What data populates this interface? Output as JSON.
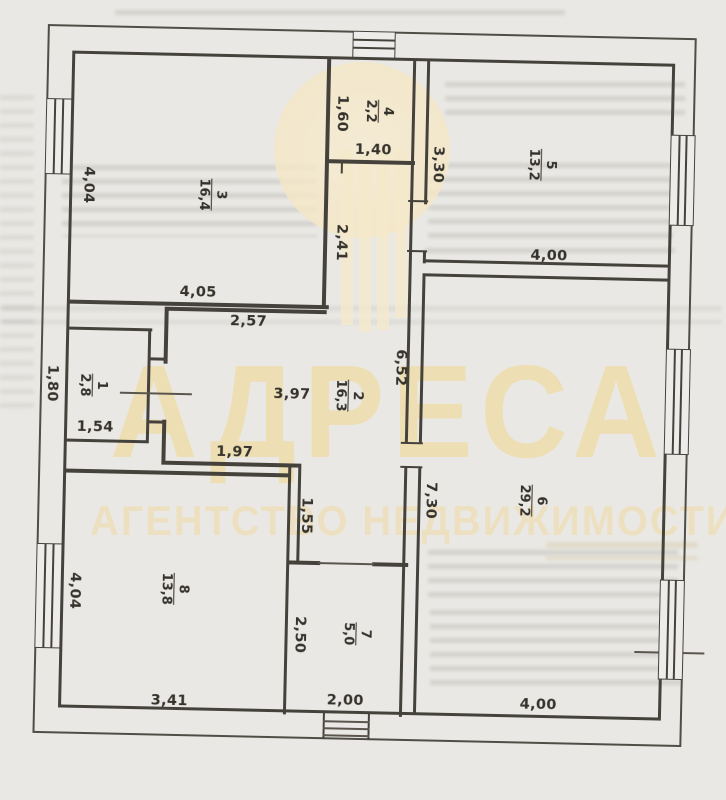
{
  "watermark": {
    "brand": "АДРЕСА",
    "tagline": "АГЕНТСТВО НЕДВИЖИМОСТИ",
    "accent_color": "#efdca8"
  },
  "rooms": [
    {
      "num": "1",
      "area": "2,8"
    },
    {
      "num": "2",
      "area": "16,3"
    },
    {
      "num": "3",
      "area": "16,4"
    },
    {
      "num": "4",
      "area": "2,2"
    },
    {
      "num": "5",
      "area": "13,2"
    },
    {
      "num": "6",
      "area": "29,2"
    },
    {
      "num": "7",
      "area": "5,0"
    },
    {
      "num": "8",
      "area": "13,8"
    }
  ],
  "dimensions": {
    "room1_left": "1,80",
    "room1_bottom": "1,54",
    "room2_top": "2,57",
    "room2_width": "3,97",
    "room2_right": "6,52",
    "hall_bottom": "1,97",
    "hall_jog": "1,55",
    "room3_left": "4,04",
    "room3_bottom": "4,05",
    "corridor_right": "2,41",
    "room4_left": "1,60",
    "room4_bottom": "1,40",
    "room5_left": "3,30",
    "room5_bottom": "4,00",
    "room6_left": "7,30",
    "room6_bottom": "4,00",
    "room7_left": "2,50",
    "room7_bottom": "2,00",
    "room8_left": "4,04",
    "room8_bottom": "3,41"
  }
}
